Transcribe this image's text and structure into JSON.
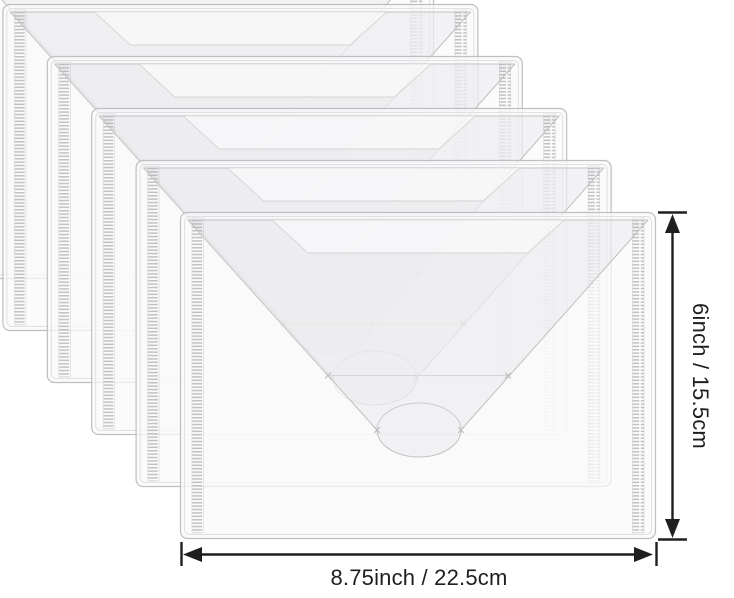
{
  "page": {
    "background": "#ffffff",
    "type": "product-dimension-illustration"
  },
  "envelopes": {
    "count": 6,
    "description": "translucent clear poly document envelopes with V flap and round hook-and-loop closure tab, stacked in a cascading overlap",
    "edge_color": "#bfbfc1",
    "soft_line_color": "#e0e0e2",
    "detail_line_color": "#d4d4d6",
    "body_fill": "rgba(250,250,251,0.72)",
    "flap_fill": "rgba(125,125,132,0.065)",
    "band_fill": "rgba(255,255,255,0.5)",
    "hatch_color": "#c1c1c3"
  },
  "annotations": {
    "color": "#1f1f1f",
    "width": {
      "label": "8.75inch / 22.5cm"
    },
    "height": {
      "label": "6inch / 15.5cm"
    }
  }
}
